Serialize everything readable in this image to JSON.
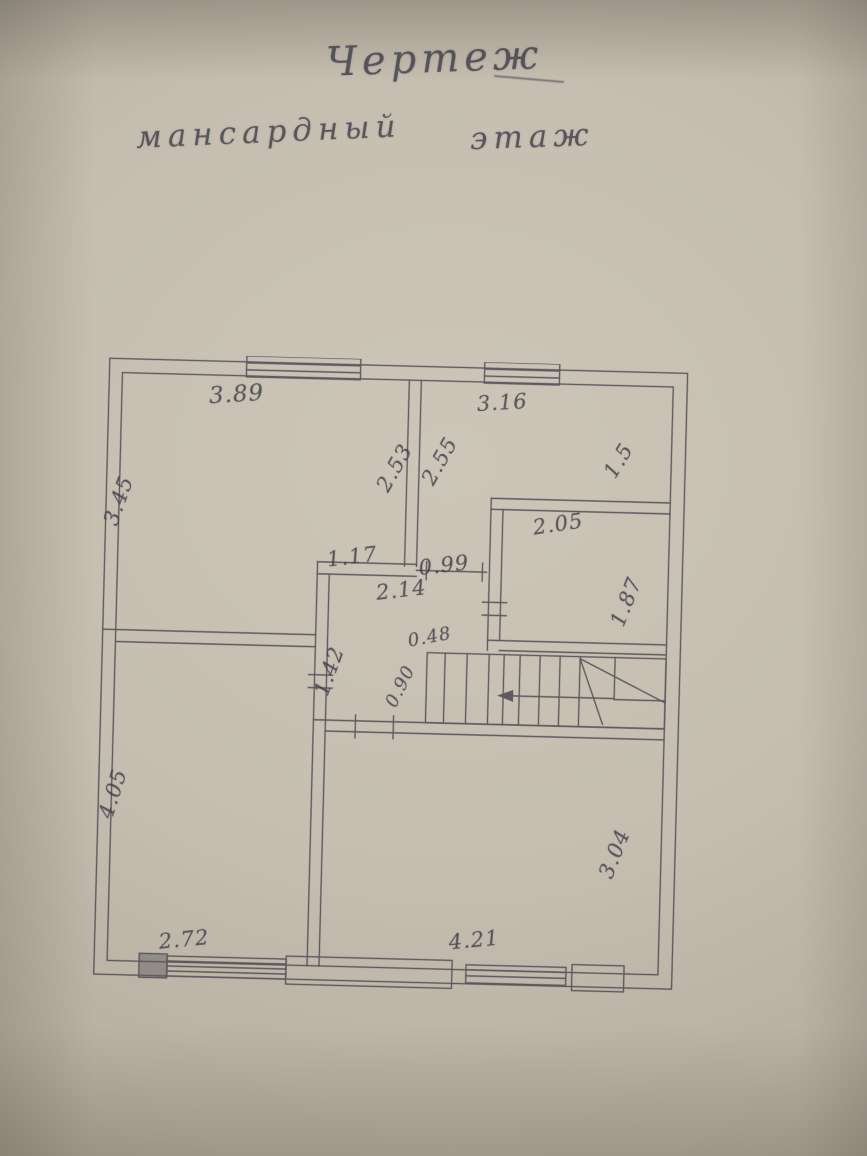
{
  "title": {
    "line1": "Чертеж",
    "line2_word1": "мансардный",
    "line2_word2": "этаж"
  },
  "colors": {
    "paper": "#c4bdaf",
    "ink": "#3c3b47",
    "pencil_line": "#46444f"
  },
  "plan": {
    "labels": [
      {
        "name": "dim-top-left-room-width",
        "text": "3.89"
      },
      {
        "name": "dim-top-right-room-width",
        "text": "3.16"
      },
      {
        "name": "dim-top-left-room-depth",
        "text": "3.45"
      },
      {
        "name": "dim-mid-wall-left",
        "text": "2.53"
      },
      {
        "name": "dim-mid-wall-right",
        "text": "2.55"
      },
      {
        "name": "dim-top-right-room-depth",
        "text": "1.5"
      },
      {
        "name": "dim-closet-width",
        "text": "2.05"
      },
      {
        "name": "dim-closet-depth",
        "text": "1.87"
      },
      {
        "name": "dim-hall-wall",
        "text": "1.17"
      },
      {
        "name": "dim-door-opening",
        "text": "0.99"
      },
      {
        "name": "dim-hall-width",
        "text": "2.14"
      },
      {
        "name": "dim-stair-offset",
        "text": "0.48"
      },
      {
        "name": "dim-hall-depth",
        "text": "1.42"
      },
      {
        "name": "dim-stair-width",
        "text": "0.90"
      },
      {
        "name": "dim-bottom-left-room-depth",
        "text": "4.05"
      },
      {
        "name": "dim-bottom-left-room-width",
        "text": "2.72"
      },
      {
        "name": "dim-bottom-right-room-width",
        "text": "4.21"
      },
      {
        "name": "dim-bottom-right-room-depth",
        "text": "3.04"
      }
    ]
  }
}
